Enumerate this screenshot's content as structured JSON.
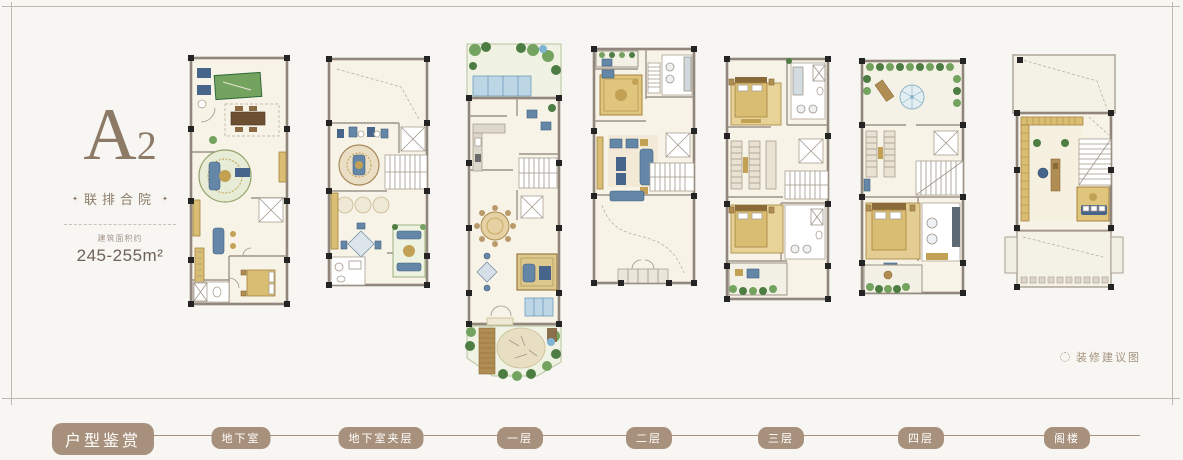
{
  "unit": {
    "name": "A",
    "number": "2",
    "category": "联排合院",
    "area_label": "建筑面积约",
    "area_value": "245-255m²",
    "diamond": "✦"
  },
  "decor_note": "装修建议图",
  "nav": {
    "title": "户型鉴赏",
    "floors": [
      "地下室",
      "地下室夹层",
      "一层",
      "二层",
      "三层",
      "四层",
      "阁楼"
    ]
  },
  "colors": {
    "accent_brown": "#a8917c",
    "text_brown": "#8d7a66",
    "frame_gray": "#bcb8b2",
    "wall_taupe": "#90867b",
    "floor_cream": "#f8f3e7"
  }
}
